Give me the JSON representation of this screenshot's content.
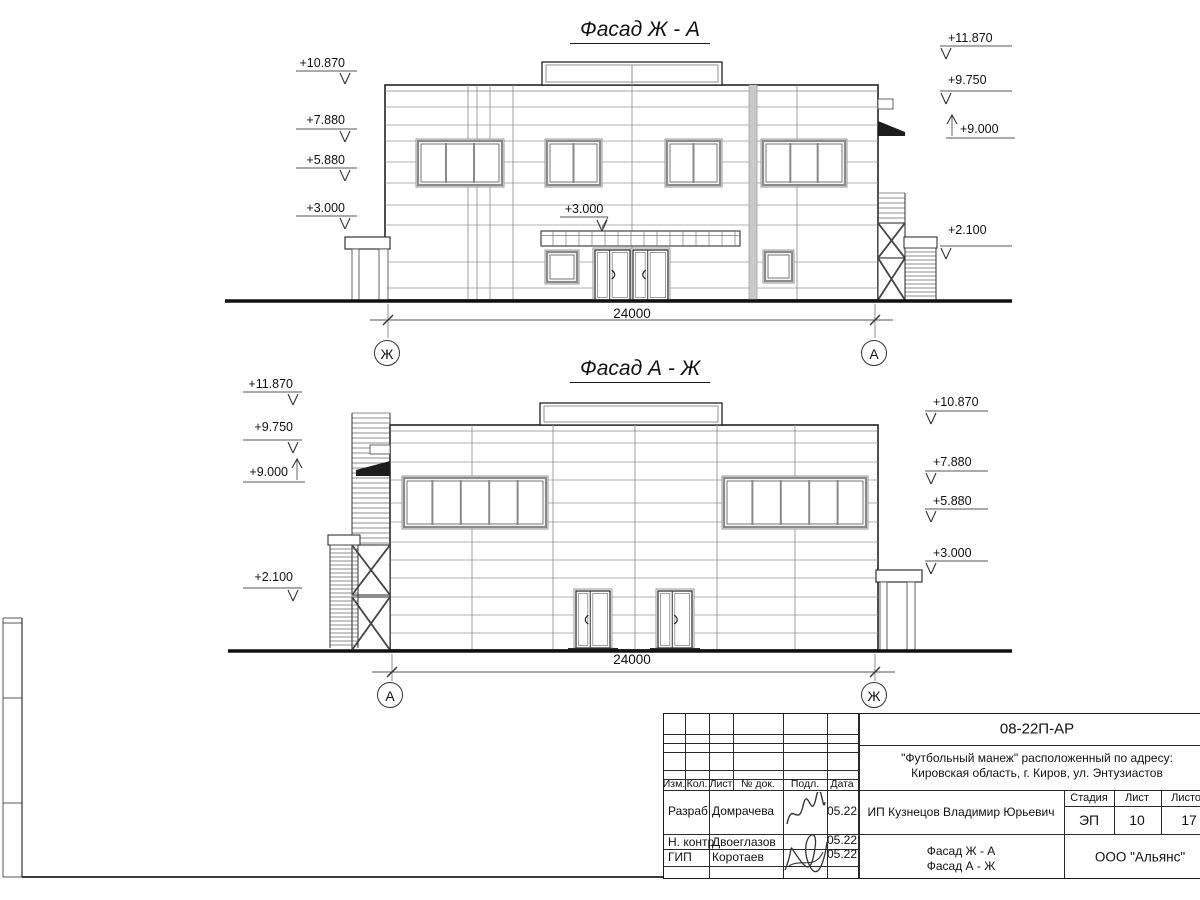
{
  "facades": {
    "top": {
      "title": "Фасад Ж - А",
      "left_marks": [
        "+10.870",
        "+7.880",
        "+5.880",
        "+3.000"
      ],
      "right_marks": [
        "+11.870",
        "+9.750",
        "+9.000",
        "+2.100"
      ],
      "center_mark": "+3.000",
      "dimension": "24000",
      "axis_left": "Ж",
      "axis_right": "А"
    },
    "bottom": {
      "title": "Фасад А - Ж",
      "left_marks": [
        "+11.870",
        "+9.750",
        "+9.000",
        "+2.100"
      ],
      "right_marks": [
        "+10.870",
        "+7.880",
        "+5.880",
        "+3.000"
      ],
      "dimension": "24000",
      "axis_left": "А",
      "axis_right": "Ж"
    }
  },
  "title_block": {
    "doc_code": "08-22П-АР",
    "project_line1": "\"Футбольный манеж\" расположенный по адресу:",
    "project_line2": "Кировская область, г. Киров, ул. Энтузиастов",
    "client": "ИП Кузнецов Владимир Юрьевич",
    "sheet_name_line1": "Фасад Ж - А",
    "sheet_name_line2": "Фасад А - Ж",
    "company": "ООО \"Альянс\"",
    "stage_label": "Стадия",
    "sheet_label": "Лист",
    "sheets_label": "Листов",
    "stage_value": "ЭП",
    "sheet_value": "10",
    "sheets_value": "17",
    "columns": [
      "Изм.",
      "Кол.",
      "Лист",
      "№ док.",
      "Подл.",
      "Дата"
    ],
    "signoff_rows": [
      {
        "role": "Разраб.",
        "name": "Домрачева",
        "date": "05.22"
      },
      {
        "role": "Н. контр.",
        "name": "Двоеглазов",
        "date": "05.22"
      },
      {
        "role": "ГИП",
        "name": "Коротаев",
        "date": "05.22"
      }
    ]
  }
}
